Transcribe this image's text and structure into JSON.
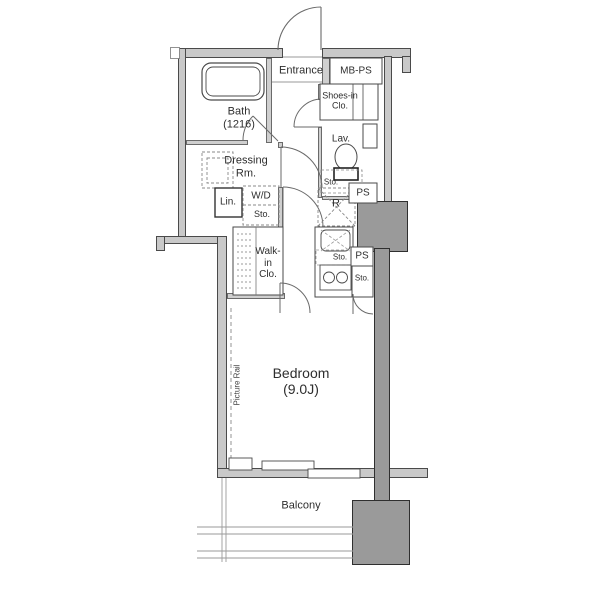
{
  "labels": {
    "entrance": "Entrance",
    "mb_ps": "MB-PS",
    "shoes_in_clo": "Shoes-in\nClo.",
    "bath": "Bath\n(1216)",
    "lav": "Lav.",
    "lav_sto": "Sto.",
    "dressing_rm": "Dressing\nRm.",
    "lin": "Lin.",
    "wd": "W/D",
    "wd_sto": "Sto.",
    "walk_in_clo": "Walk-\nin\nClo.",
    "refrigerator": "R",
    "kitchen_sto": "Sto.",
    "ps_upper": "PS",
    "ps_lower": "PS",
    "side_sto": "Sto.",
    "bedroom": "Bedroom\n(9.0J)",
    "picture_rail": "Picture Rail",
    "balcony": "Balcony"
  },
  "colors": {
    "background": "#ffffff",
    "wall_fill": "#c9c9c9",
    "column_fill": "#9a9a9a",
    "outline": "#4a4a4a",
    "thin_line": "#888888",
    "text": "#2e2e2e"
  }
}
